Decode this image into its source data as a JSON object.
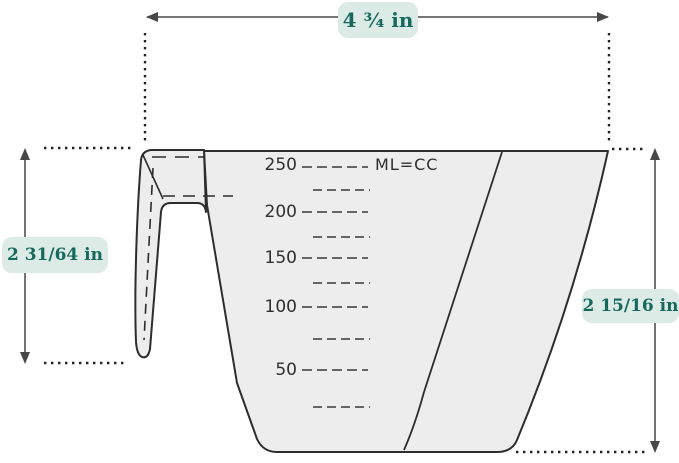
{
  "figure": {
    "title": "Measuring cup dimensions diagram",
    "background_color": "#ffffff",
    "outline_color": "#2d2d2d",
    "cup_fill_color": "#ededed",
    "accent_text_color": "#17695d",
    "accent_pill_color": "#dcebe5"
  },
  "dimensions": {
    "width_top": "4 ¾ in",
    "height_left": "2 31/64 in",
    "height_right": "2 15/16 in"
  },
  "cup": {
    "unit_label": "ML=CC",
    "scale_labels": [
      "250",
      "200",
      "150",
      "100",
      "50"
    ]
  }
}
